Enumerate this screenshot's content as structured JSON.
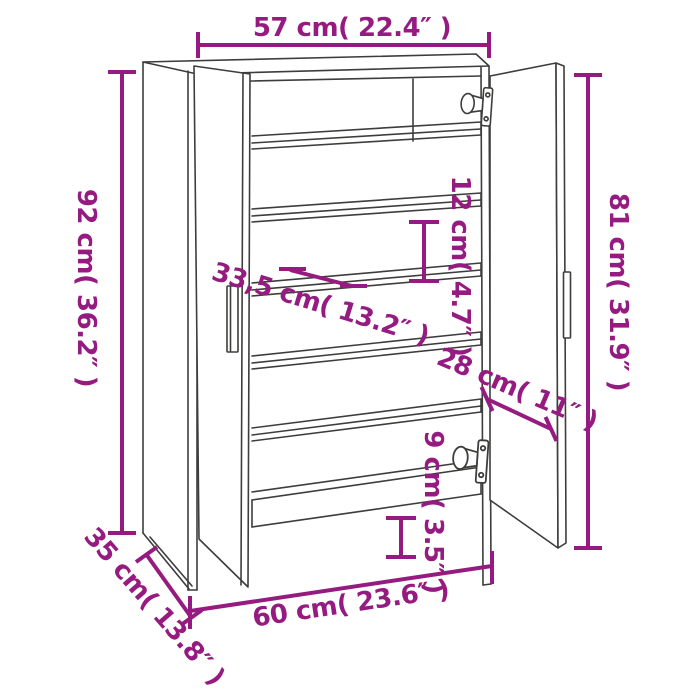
{
  "diagram": {
    "title": "shoe-cabinet-dimension-diagram",
    "colors": {
      "dimension": "#951b81",
      "outline": "#3d3d3c",
      "background": "#ffffff"
    },
    "dimensions": {
      "top_width": {
        "label": "57 cm( 22.4″ )",
        "cm": 57,
        "inch": 22.4
      },
      "overall_height": {
        "label": "92 cm( 36.2″ )",
        "cm": 92,
        "inch": 36.2
      },
      "door_height": {
        "label": "81 cm( 31.9″ )",
        "cm": 81,
        "inch": 31.9
      },
      "compartment_height": {
        "label": "12 cm( 4.7″ )",
        "cm": 12,
        "inch": 4.7
      },
      "shelf_depth": {
        "label": "33,5 cm( 13.2″ )",
        "cm": 33.5,
        "inch": 13.2
      },
      "door_width": {
        "label": "28 cm( 11″ )",
        "cm": 28,
        "inch": 11
      },
      "base_clearance": {
        "label": "9 cm( 3.5″ )",
        "cm": 9,
        "inch": 3.5
      },
      "bottom_width": {
        "label": "60 cm( 23.6″ )",
        "cm": 60,
        "inch": 23.6
      },
      "depth": {
        "label": "35 cm( 13.8″ )",
        "cm": 35,
        "inch": 13.8
      }
    },
    "features": {
      "shelf_count": 5,
      "doors": 2,
      "hinges": 2,
      "handles": 2
    }
  }
}
